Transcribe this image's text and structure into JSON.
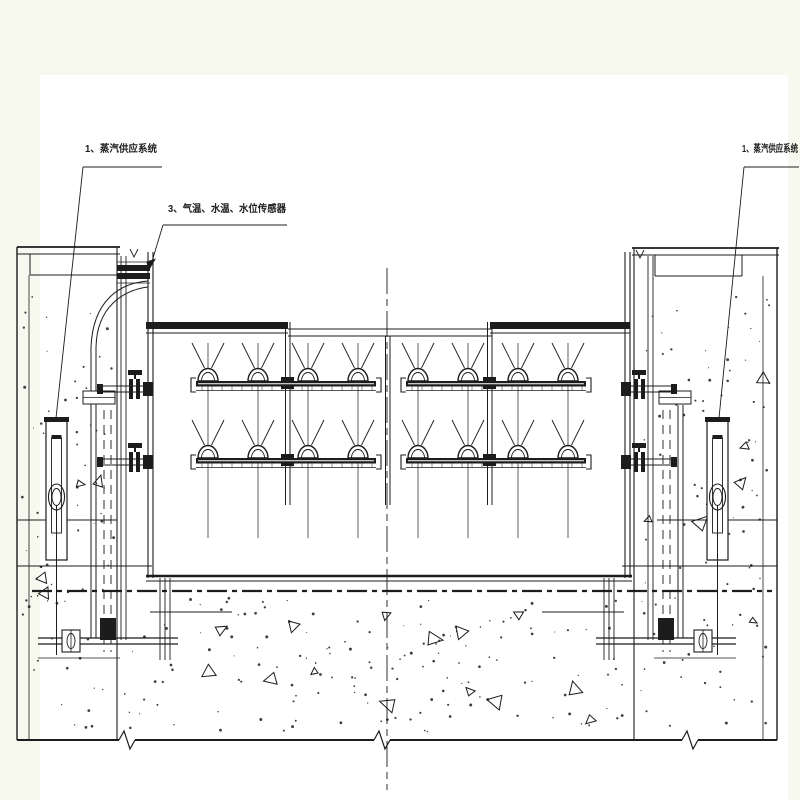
{
  "page": {
    "background_color": "#f7f9ef",
    "canvas_color": "#ffffff",
    "ink_color": "#1c1c1c"
  },
  "annotations": {
    "left_system": "1、蒸汽供应系统",
    "sensors": "3、气温、水温、水位传感器",
    "right_system": "1、蒸汽供应系统"
  }
}
